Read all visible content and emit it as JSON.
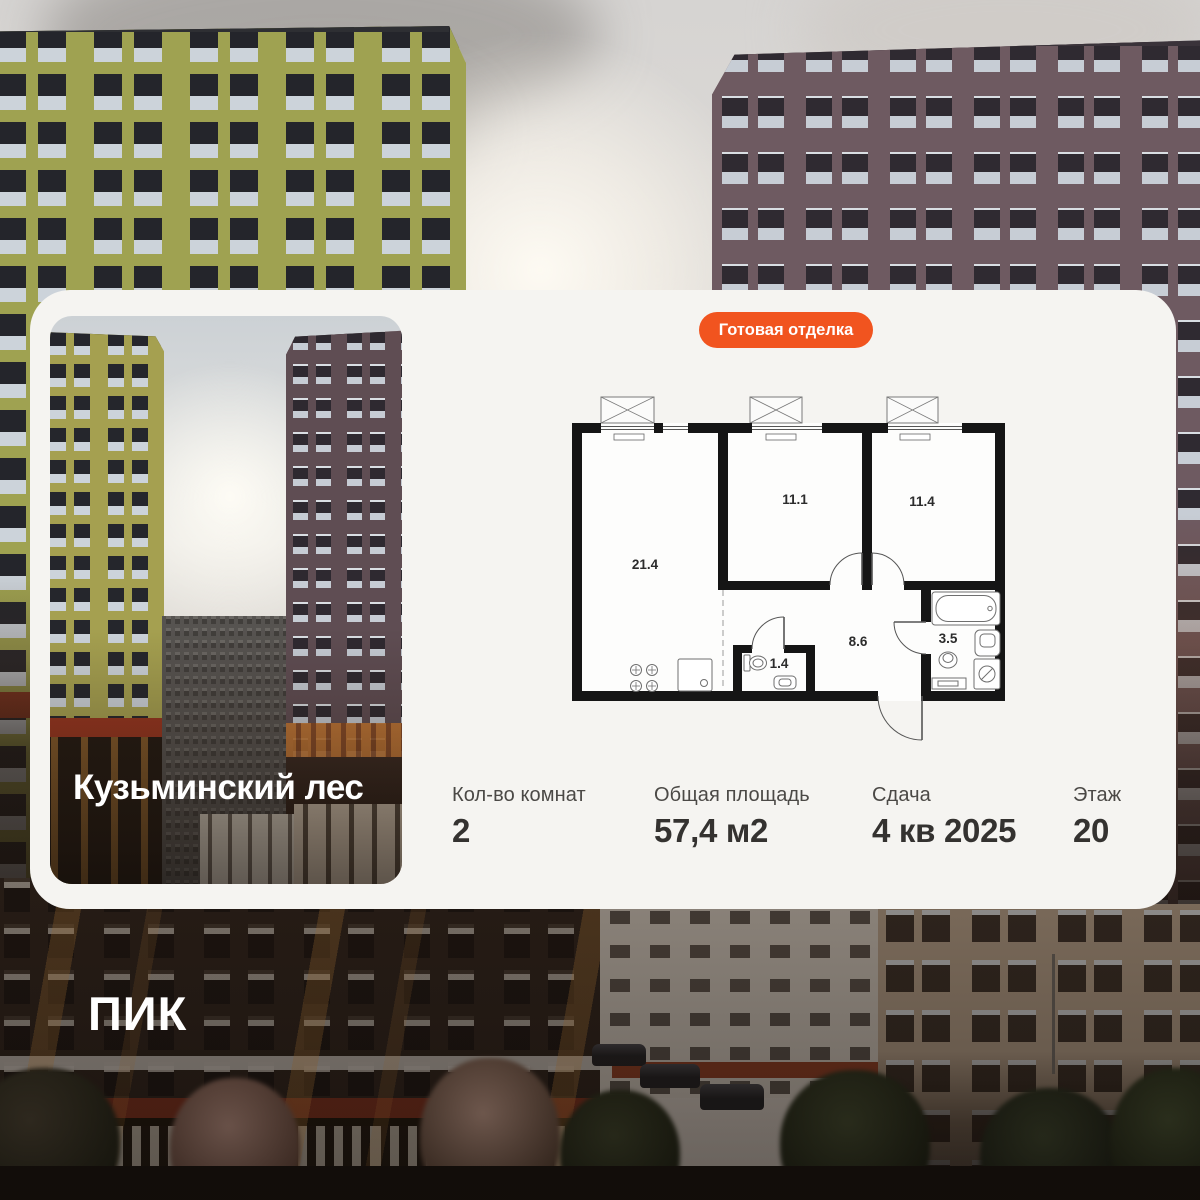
{
  "badge": {
    "label": "Готовая отделка"
  },
  "project": {
    "name": "Кузьминский лес"
  },
  "brand": {
    "logo": "ПИК"
  },
  "floor_plan": {
    "rooms": [
      {
        "id": "living-room",
        "area": "21.4"
      },
      {
        "id": "bedroom-1",
        "area": "11.1"
      },
      {
        "id": "bedroom-2",
        "area": "11.4"
      },
      {
        "id": "hallway",
        "area": "8.6"
      },
      {
        "id": "bathroom",
        "area": "3.5"
      },
      {
        "id": "wc",
        "area": "1.4"
      }
    ]
  },
  "specs": [
    {
      "label": "Кол-во комнат",
      "value": "2"
    },
    {
      "label": "Общая площадь",
      "value": "57,4 м2"
    },
    {
      "label": "Сдача",
      "value": "4 кв 2025"
    },
    {
      "label": "Этаж",
      "value": "20"
    }
  ],
  "colors": {
    "accent_orange": "#F1541F",
    "card_background": "#F5F4F1"
  }
}
